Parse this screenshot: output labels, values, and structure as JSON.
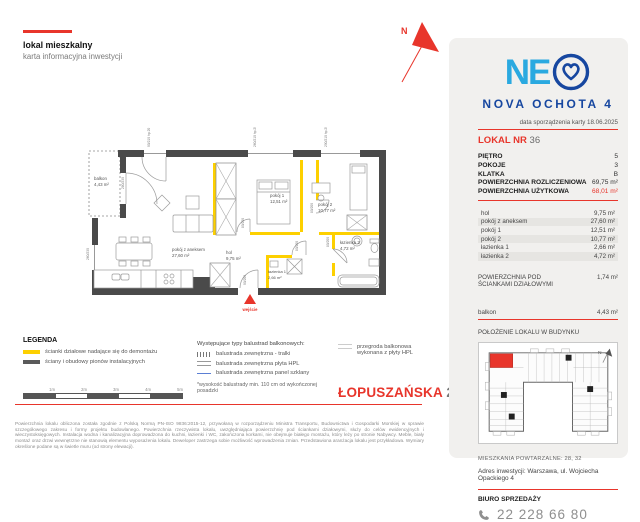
{
  "header": {
    "title": "lokal mieszkalny",
    "subtitle": "karta informacyjna inwestycji"
  },
  "brand": {
    "logo_text": "NE",
    "name": "NOVA OCHOTA 4",
    "date_note": "data sporządzenia karty 18.06.2025",
    "unit_label": "LOKAL NR",
    "unit_number": "36"
  },
  "specs": [
    {
      "label": "PIĘTRO",
      "value": "5"
    },
    {
      "label": "POKOJE",
      "value": "3"
    },
    {
      "label": "KLATKA",
      "value": "B"
    },
    {
      "label": "POWIERZCHNIA ROZLICZENIOWA",
      "value": "69,75 m²"
    },
    {
      "label": "POWIERZCHNIA UŻYTKOWA",
      "value": "68,01 m²"
    }
  ],
  "rooms": [
    {
      "label": "hol",
      "value": "9,75 m²"
    },
    {
      "label": "pokój z aneksem",
      "value": "27,60 m²"
    },
    {
      "label": "pokój 1",
      "value": "12,51 m²"
    },
    {
      "label": "pokój 2",
      "value": "10,77 m²"
    },
    {
      "label": "łazienka 1",
      "value": "2,66 m²"
    },
    {
      "label": "łazienka 2",
      "value": "4,72 m²"
    }
  ],
  "partition_area": {
    "label": "POWIERZCHNIA POD ŚCIANKAMI DZIAŁOWYMI",
    "value": "1,74 m²"
  },
  "balcony_row": {
    "label": "balkon",
    "value": "4,43 m²"
  },
  "location": {
    "title": "POŁOŻENIE LOKALU W BUDYNKU",
    "north": "N"
  },
  "footer": {
    "repeat_units": "MIESZKANIA POWTARZALNE: 28, 32",
    "address": "Adres inwestycji: Warszawa, ul. Wojciecha Opackiego 4",
    "sales_office": "BIURO SPRZEDAŻY",
    "phone": "22 228 66 80"
  },
  "legend": {
    "title": "LEGENDA",
    "items": [
      {
        "label": "ścianki działowe nadające się do demontażu"
      },
      {
        "label": "ściany i obudowy pionów instalacyjnych"
      }
    ],
    "scale_labels": [
      "1m",
      "2m",
      "3m",
      "4m",
      "5m"
    ],
    "balustrade_title": "Występujące typy balustrad balkonowych:",
    "balustrades": [
      {
        "label": "balustrada zewnętrzna - tralki"
      },
      {
        "label": "balustrada zewnętrzna płyta HPL"
      },
      {
        "label": "balustrada zewnętrzna panel szklany"
      }
    ],
    "balustrade_note": "*wysokość balustrady min. 110 cm od wykończonej posadzki",
    "partition_note": "przegroda balkonowa wykonana z płyty HPL"
  },
  "street": {
    "name": "ŁOPUSZAŃSKA",
    "number": "235"
  },
  "compass": {
    "label": "N"
  },
  "plan": {
    "rooms": [
      {
        "name": "balkon",
        "area": "4,43 m²"
      },
      {
        "name": "pokój z aneksem",
        "area": "27,60 m²"
      },
      {
        "name": "hol",
        "area": "9,75 m²"
      },
      {
        "name": "pokój 1",
        "area": "12,51 m²"
      },
      {
        "name": "pokój 2",
        "area": "10,77 m²"
      },
      {
        "name": "łazienka 1",
        "area": "2,66 m²"
      },
      {
        "name": "łazienka 2",
        "area": "4,72 m²"
      }
    ],
    "windows": [
      "90/210 hp 20",
      "260/210 hp 20",
      "200/210 hp 20",
      "260/230"
    ],
    "doors": [
      "280/230",
      "80/200",
      "80/200",
      "80/200",
      "80/200",
      "90/200"
    ],
    "entry": "wejście"
  },
  "disclaimer": "Powierzchnia lokalu obliczona została zgodnie z Polską Normą PN-ISO 9836:2015-12, przywołaną w rozporządzeniu Ministra Transportu, Budownictwa i Gospodarki Morskiej w sprawie szczegółowego zakresu i formy projektu budowlanego. Powierzchnia rzeczywista lokalu, uwzględniająca powierzchnię pod ściankami działowymi, służy do celów ewidencyjnych i wieczystoksięgowych. Instalacja wodna i kanalizacyjna doprowadzona do kuchni, łazienki i WC, zakończona korkami, nie obejmuje białego montażu, który leży po stronie Nabywcy. Meble, biały montaż oraz drzwi wewnętrzne nie stanowią elementu wyposażenia lokalu. Deweloper zastrzega sobie możliwość wprowadzenia zmian. Przedstawiona aranżacja lokalu jest przykładowa. Wymiary określone podane są w świetle muru (od strony elewacji).",
  "colors": {
    "accent_red": "#e8352b",
    "demolition_yellow": "#fdd000",
    "wall_gray": "#4a4a4a",
    "logo_light_blue": "#2aa9e0",
    "logo_dark_blue": "#1747a0",
    "panel_bg": "#f1f0ee"
  }
}
